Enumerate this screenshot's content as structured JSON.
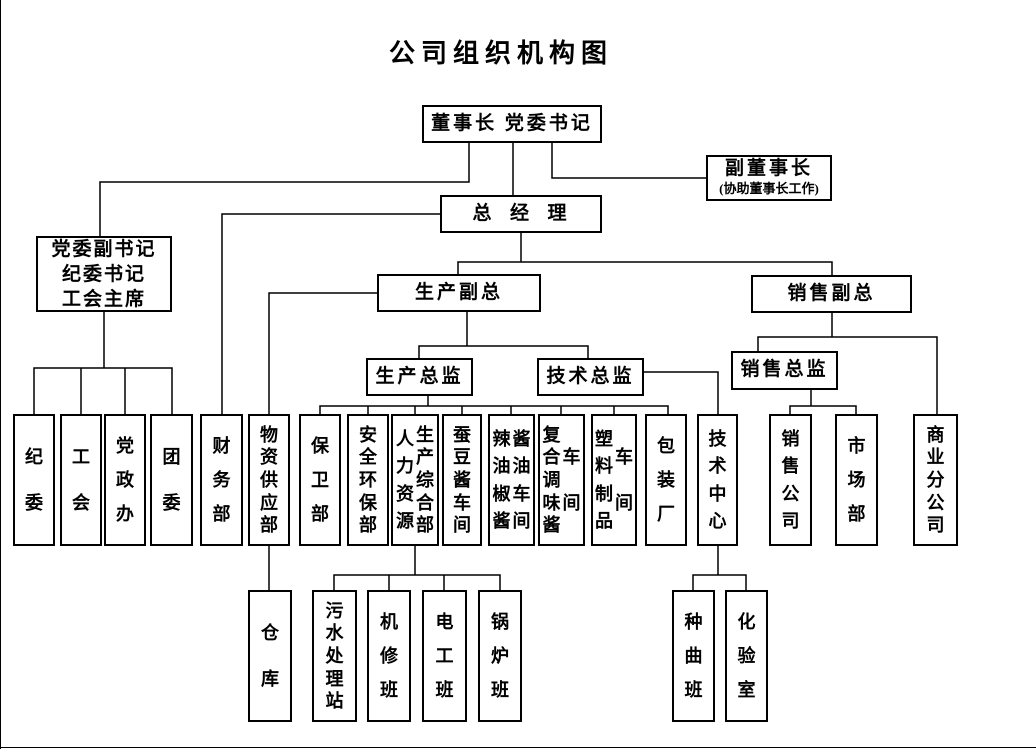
{
  "title": "公司组织机构图",
  "executives": {
    "chairman": "董事长 党委书记",
    "vice_chairman": "副董事长",
    "vice_chairman_note": "(协助董事长工作)",
    "general_manager": "总  经  理",
    "party_secretary_lines": [
      "党委副书记",
      "纪委书记",
      "工会主席"
    ],
    "production_vp": "生产副总",
    "sales_vp": "销售副总",
    "production_director": "生产总监",
    "technical_director": "技术总监",
    "sales_director": "销售总监"
  },
  "departments": {
    "discipline_committee": "纪委",
    "labor_union": "工会",
    "party_admin_office": "党政办",
    "youth_league": "团委",
    "finance_dept": "财务部",
    "material_supply_dept": "物资供应部",
    "security_dept": "保卫部",
    "safety_env_dept": "安全环保部",
    "hr_col": "人力资源",
    "production_general_col": "生产综合部",
    "broad_bean_paste_workshop": "蚕豆酱车间",
    "chili_paste_col": "辣油椒酱",
    "soy_sauce_workshop_col": "酱油车间",
    "compound_seasoning_col": "复合调味酱",
    "compound_seasoning_workshop_col": "车间",
    "plastic_products_col": "塑料制品",
    "plastic_workshop_col": "车间",
    "packaging_factory": "包装厂",
    "technical_center": "技术中心",
    "sales_company": "销售公司",
    "marketing_dept": "市场部",
    "commercial_branch": "商业分公司"
  },
  "teams": {
    "warehouse": "仓库",
    "sewage_treatment_station": "污水处理站",
    "machine_repair_team": "机修班",
    "electrician_team": "电工班",
    "boiler_team": "锅炉班",
    "koji_culture_team": "种曲班",
    "laboratory": "化验室"
  }
}
